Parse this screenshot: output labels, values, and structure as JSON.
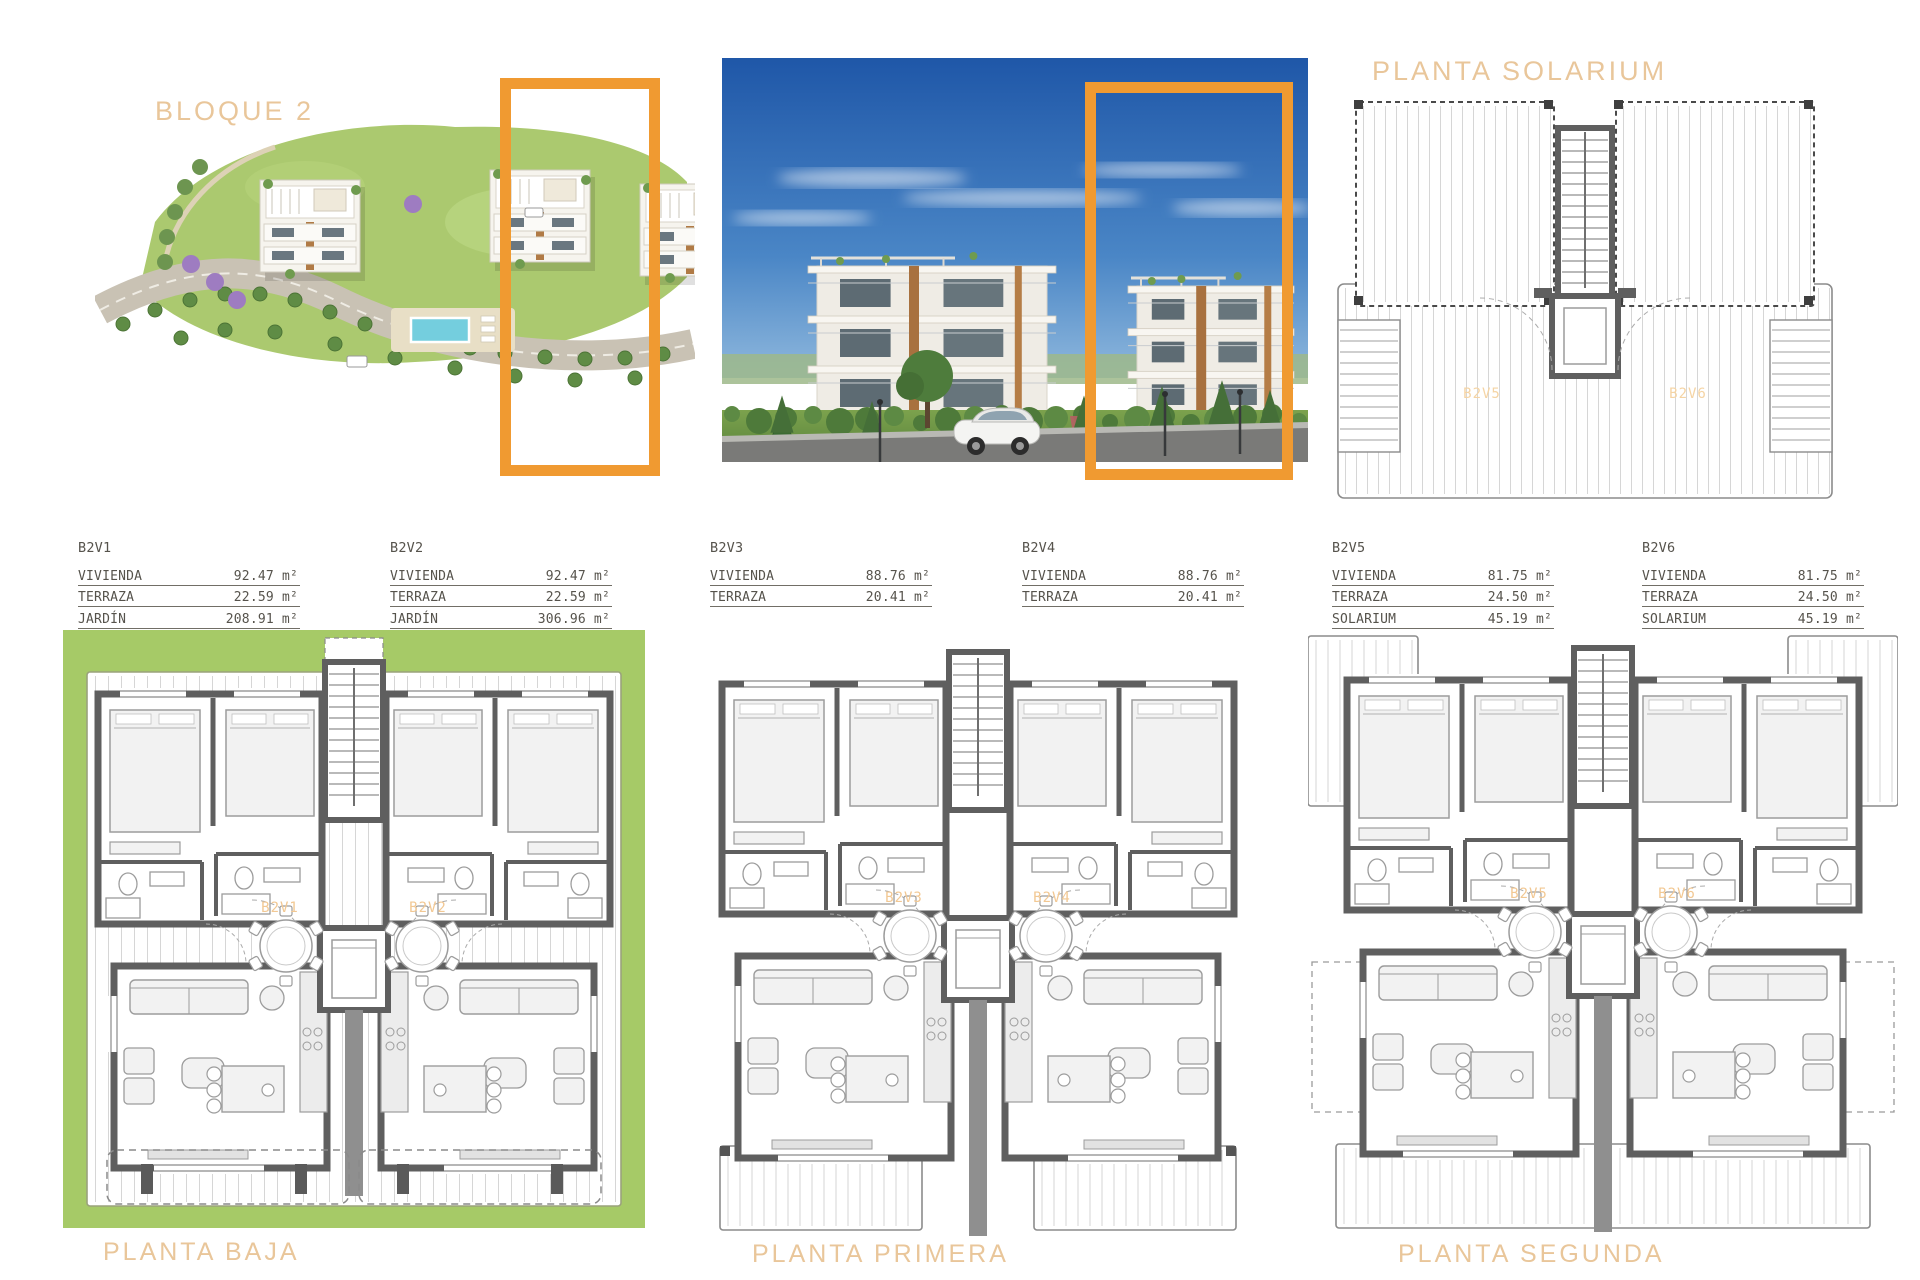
{
  "titles": {
    "bloque": "BLOQUE 2",
    "solarium": "PLANTA SOLARIUM"
  },
  "plan_labels": {
    "baja": "PLANTA BAJA",
    "primera": "PLANTA PRIMERA",
    "segunda": "PLANTA SEGUNDA"
  },
  "unit_tables": [
    {
      "id": "B2V1",
      "rows": [
        {
          "label": "VIVIENDA",
          "value": "92.47 m²"
        },
        {
          "label": "TERRAZA",
          "value": "22.59 m²"
        },
        {
          "label": "JARDÍN",
          "value": "208.91 m²"
        }
      ]
    },
    {
      "id": "B2V2",
      "rows": [
        {
          "label": "VIVIENDA",
          "value": "92.47 m²"
        },
        {
          "label": "TERRAZA",
          "value": "22.59 m²"
        },
        {
          "label": "JARDÍN",
          "value": "306.96 m²"
        }
      ]
    },
    {
      "id": "B2V3",
      "rows": [
        {
          "label": "VIVIENDA",
          "value": "88.76 m²"
        },
        {
          "label": "TERRAZA",
          "value": "20.41 m²"
        }
      ]
    },
    {
      "id": "B2V4",
      "rows": [
        {
          "label": "VIVIENDA",
          "value": "88.76 m²"
        },
        {
          "label": "TERRAZA",
          "value": "20.41 m²"
        }
      ]
    },
    {
      "id": "B2V5",
      "rows": [
        {
          "label": "VIVIENDA",
          "value": "81.75 m²"
        },
        {
          "label": "TERRAZA",
          "value": "24.50 m²"
        },
        {
          "label": "SOLARIUM",
          "value": "45.19 m²"
        }
      ]
    },
    {
      "id": "B2V6",
      "rows": [
        {
          "label": "VIVIENDA",
          "value": "81.75 m²"
        },
        {
          "label": "TERRAZA",
          "value": "24.50 m²"
        },
        {
          "label": "SOLARIUM",
          "value": "45.19 m²"
        }
      ]
    }
  ],
  "floor_units": {
    "baja": [
      "B2V1",
      "B2V2"
    ],
    "primera": [
      "B2V3",
      "B2V4"
    ],
    "segunda": [
      "B2V5",
      "B2V6"
    ],
    "solarium": [
      "B2V5",
      "B2V6"
    ]
  },
  "colors": {
    "accent_orange": "#f09a31",
    "title_tan": "#e9c69a",
    "plan_label_tan": "#f2c893",
    "garden_green": "#a6ca67",
    "wall_gray": "#5f5f5f",
    "sky_blue": "#2b64b5"
  }
}
